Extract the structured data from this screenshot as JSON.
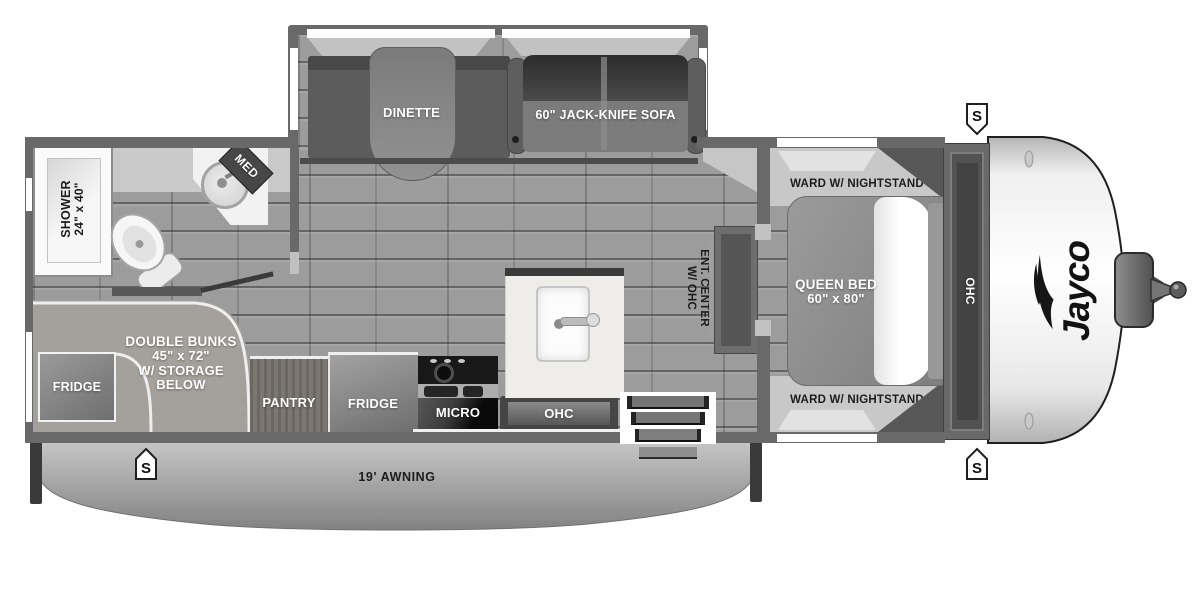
{
  "plan": {
    "slideout": {
      "dinette_label": "DINETTE",
      "sofa_label": "60\" JACK-KNIFE SOFA"
    },
    "bathroom": {
      "shower_line1": "SHOWER",
      "shower_line2": "24\" x 40\"",
      "med_label": "MED"
    },
    "bunk_room": {
      "line1": "DOUBLE BUNKS",
      "line2": "45\" x 72\"",
      "line3": "W/ STORAGE",
      "line4": "BELOW",
      "fridge_label": "FRIDGE"
    },
    "kitchen": {
      "pantry_label": "PANTRY",
      "fridge_label": "FRIDGE",
      "micro_label": "MICRO",
      "ohc_label": "OHC"
    },
    "living": {
      "ent_center_line1": "ENT. CENTER",
      "ent_center_line2": "W/ OHC"
    },
    "bedroom": {
      "ward_top_label": "WARD W/ NIGHTSTAND",
      "ward_bottom_label": "WARD W/ NIGHTSTAND",
      "bed_line1": "QUEEN BED",
      "bed_line2": "60\" x 80\"",
      "ohc_label": "OHC"
    },
    "exterior": {
      "awning_label": "19' AWNING",
      "brand": "Jayco",
      "speaker_label": "S"
    },
    "colors": {
      "wall": "#696969",
      "floor": "#9c9c9c",
      "light_band": "#c8c8c8",
      "dark_appliance": "#1a1a1a",
      "white": "#ffffff"
    }
  }
}
